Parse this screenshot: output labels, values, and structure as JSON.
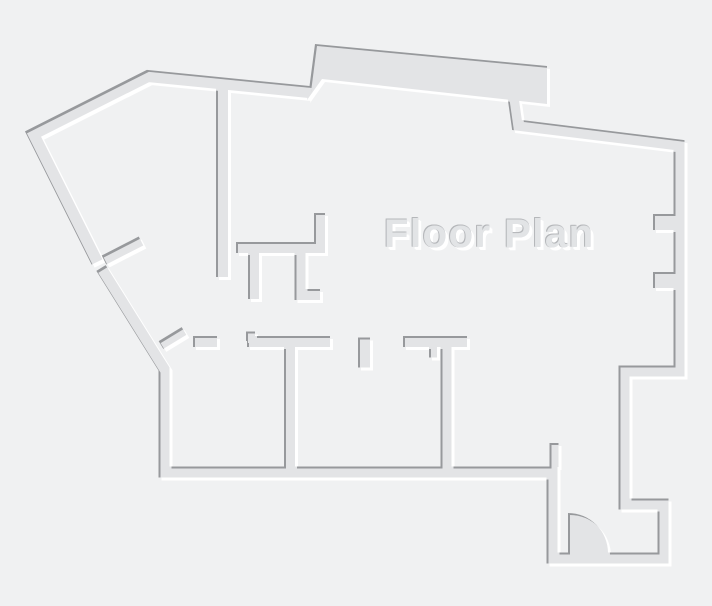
{
  "canvas": {
    "width": 712,
    "height": 606,
    "background": "#f0f1f2"
  },
  "title": "Floor Plan",
  "plan": {
    "label": "Floor Plan",
    "colors": {
      "background": "#f0f1f2",
      "wall_fill": "#e3e4e6",
      "edge_dark": "#97999c",
      "edge_highlight": "#ffffff",
      "label_fill": "#e2e4e6",
      "label_edge_dark": "#b5b7ba",
      "label_edge_light": "#ffffff"
    },
    "walls": [
      {
        "id": "outer-upper-left",
        "d": "M309,92 L148,76 L33,134 L97,262",
        "w": 12
      },
      {
        "id": "outer-main",
        "d": "M101,268 L159,361 L164,369 L164,472 L552,472 L552,558 L663,558 L663,504 L624,504 L624,371 L679,371 L679,145 L517,125 L513,97",
        "w": 11
      },
      {
        "id": "top-bump-slab",
        "type": "polygon",
        "d": "M307,100 L309,90 L315,44 L547,66 L547,104 L511,100 L322,79 Z"
      },
      {
        "id": "hall-vertical",
        "d": "M222,86 L222,277",
        "w": 12
      },
      {
        "id": "closet-horizontal",
        "d": "M236,247.5 L325,247.5",
        "w": 11
      },
      {
        "id": "closet-riser",
        "d": "M319.5,213 L319.5,247",
        "w": 11
      },
      {
        "id": "closet-stub-left",
        "d": "M253.5,250 L253.5,299",
        "w": 11
      },
      {
        "id": "closet-stub-right-l",
        "d": "M300,250 L300,294.5 L320,294.5",
        "w": 11
      },
      {
        "id": "nook-diagonal-stub",
        "d": "M104,260 L141,241",
        "w": 10
      },
      {
        "id": "corner-diagonal-stub",
        "d": "M161,345 L184,331",
        "w": 9
      },
      {
        "id": "rooms-top-seg-1",
        "d": "M193,341.5 L217,341.5",
        "w": 11
      },
      {
        "id": "rooms-top-seg-2",
        "d": "M247,341.5 L330,341.5",
        "w": 11
      },
      {
        "id": "rooms-top-seg-2-jamb",
        "d": "M250.5,331.5 L250.5,341",
        "w": 9
      },
      {
        "id": "rooms-top-stub",
        "d": "M364,337.5 L364,367.5",
        "w": 12
      },
      {
        "id": "rooms-top-seg-3",
        "d": "M403,341.5 L467,341.5",
        "w": 11
      },
      {
        "id": "rooms-top-seg-3-jamb",
        "d": "M433,347 L433,357.5",
        "w": 8
      },
      {
        "id": "room-divider-1",
        "d": "M289.5,344 L289.5,467",
        "w": 11
      },
      {
        "id": "room-divider-2",
        "d": "M446,344 L446,467",
        "w": 11
      },
      {
        "id": "entry-stub",
        "d": "M554,443 L554,467",
        "w": 9
      },
      {
        "id": "right-wall-jamb-1",
        "d": "M653,222 L680,222",
        "w": 16
      },
      {
        "id": "right-wall-jamb-2",
        "d": "M653,280 L680,280",
        "w": 16
      }
    ],
    "door": {
      "id": "entry-door-swing",
      "d": "M568,513 A40,40 0 0 1 608,553 L568,553 Z"
    }
  }
}
